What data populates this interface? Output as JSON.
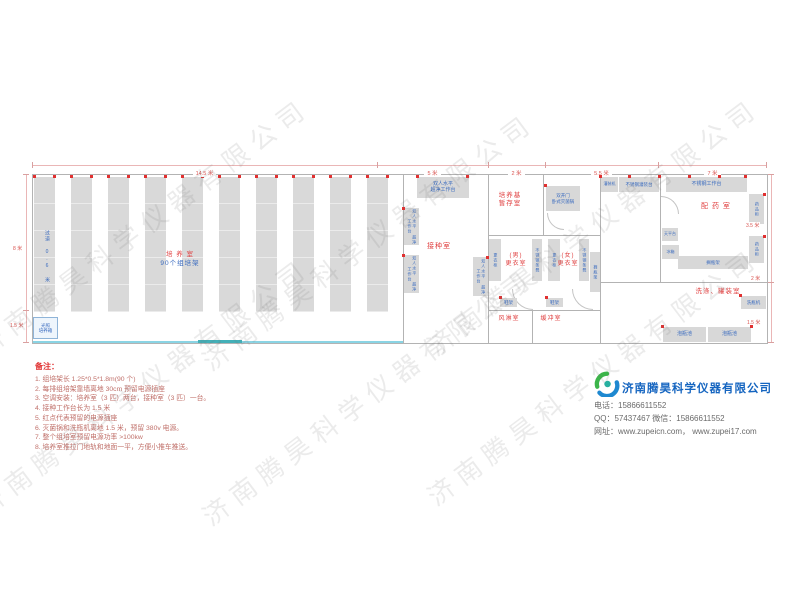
{
  "watermark": "济南腾昊科学仪器有限公司",
  "colors": {
    "room_label_red": "#e04040",
    "equip_label_blue": "#3a6bbf",
    "dimension_red": "#d9534f",
    "brand_blue": "#1565c0",
    "equip_fill": "#d8d8d8",
    "wall_gray": "#b3b3b3",
    "track_cyan": "#8ad4e4",
    "door_teal": "#43b0b8",
    "outlet_dot_red": "#e03030"
  },
  "dims": {
    "top_main": "14.5 米",
    "top_seed": "5 米",
    "top_storage": "2 米",
    "top_fill": "5.5 米",
    "top_pharm": "7 米",
    "left_top": "8 米",
    "left_bottom": "1.5 米",
    "right_top": "3.5 米",
    "right_mid": "2 米",
    "right_bottom": "1.5 米"
  },
  "rooms": {
    "culture": "培 养 室",
    "culture_sub": "90个组培架",
    "aisle": "过道 0.6 米",
    "seed": "接种室",
    "storage": "培养基\n暂存室",
    "men": "(男)\n更衣室",
    "women": "(女)\n更衣室",
    "air_shower": "风淋室",
    "buffer": "缓冲室",
    "pharmacy": "配 药 室",
    "washing": "洗涤、罐装室"
  },
  "equip": {
    "clean_bench": "双人水平\n超净工作台",
    "autoclave": "双开门\n卧式灭菌锅",
    "locker": "更衣柜",
    "ss_bench": "不锈钢条凳",
    "shoe_rack": "鞋架",
    "bottle_shelf": "搁瓶架",
    "fill_machine": "灌装机",
    "fill_table": "不锈钢灌装台",
    "work_table": "不锈钢工作台",
    "med_cabinet": "药品柜",
    "balance": "天平台",
    "fridge": "冰箱",
    "bottle_rack": "搁瓶架",
    "washer": "洗瓶机",
    "pool": "泡瓶池",
    "incubator": "光照\n培养箱"
  },
  "notes": {
    "title": "备注：",
    "items": [
      "1.  组培架长 1.25*0.5*1.8m(90 个)",
      "2.  每排组培架靠墙离地 30cm 预留电源插座",
      "3.  空调安装：培养室（3 匹）两台，接种室（3 匹）一台。",
      "4.  接种工作台长为 1.5 米",
      "5.  红点代表预留的电源插座",
      "6.  灭菌锅和洗瓶机离地 1.5 米，预留 380v 电源。",
      "7.  整个组培室预留电源功率 >100kw",
      "8.  培养室推拉门地轨和地面一平，方便小推车推送。"
    ]
  },
  "company": {
    "name": "济南腾昊科学仪器有限公司",
    "phone": "电话：15866611552",
    "qq": "QQ：57437467   微信：15866611552",
    "web": "网址：www.zupeicn.com，  www.zupei17.com"
  }
}
